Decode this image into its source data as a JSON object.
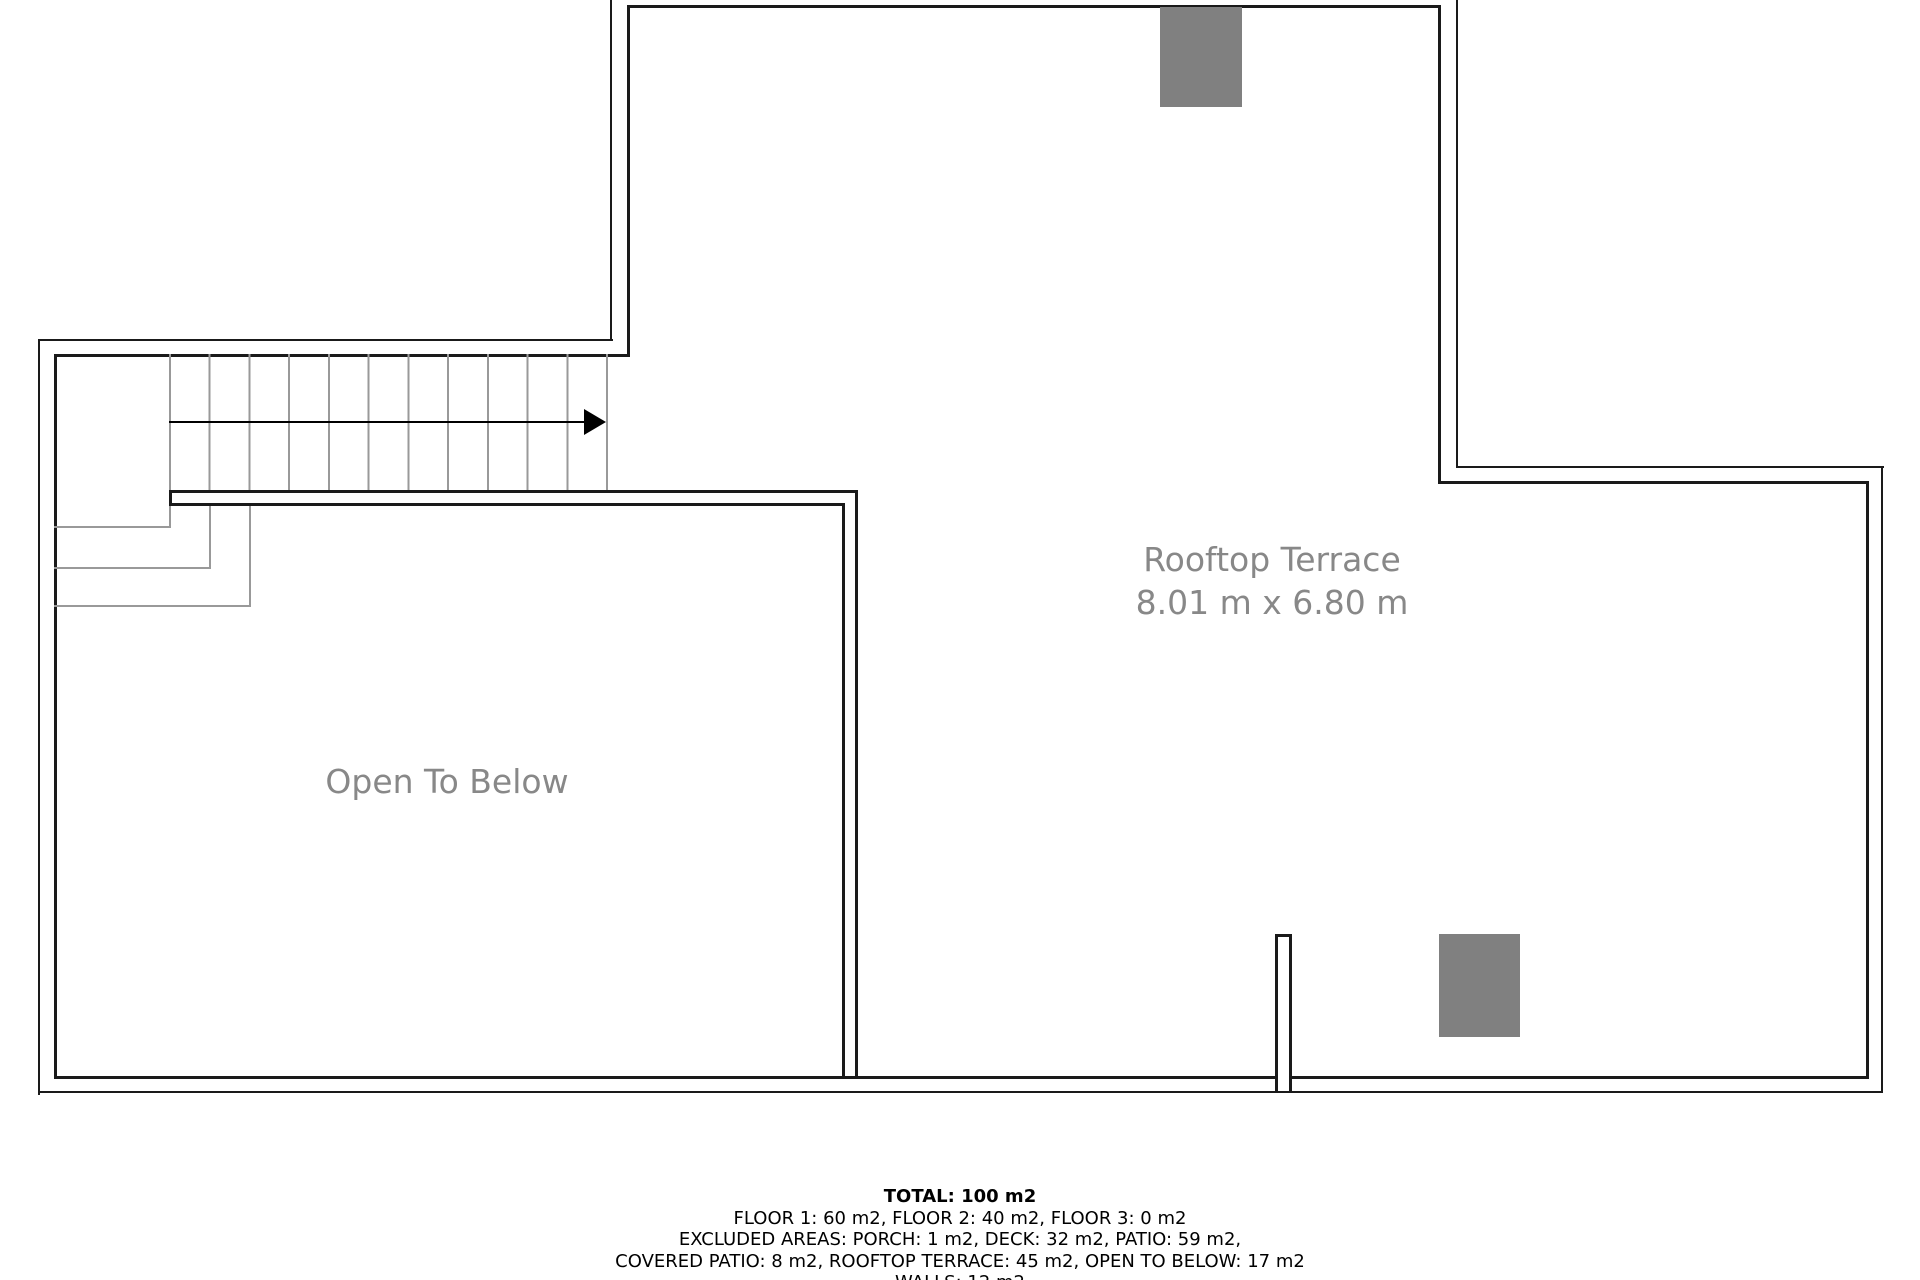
{
  "plan": {
    "labels": {
      "rooftop_terrace": "Rooftop Terrace",
      "rooftop_terrace_dimensions": "8.01 m x 6.80 m",
      "open_to_below": "Open To Below"
    },
    "colors": {
      "wall": "#1a1a1a",
      "stair_line": "#999999",
      "fixture_gray": "#808080",
      "label_gray": "#888888"
    }
  },
  "summary": {
    "total": "TOTAL: 100 m2",
    "lines": [
      "FLOOR 1: 60 m2, FLOOR 2: 40 m2, FLOOR 3: 0 m2",
      "EXCLUDED AREAS: PORCH: 1 m2, DECK: 32 m2, PATIO: 59 m2,",
      "COVERED PATIO: 8 m2, ROOFTOP TERRACE: 45 m2, OPEN TO BELOW: 17 m2",
      "WALLS: 12 m2"
    ]
  }
}
